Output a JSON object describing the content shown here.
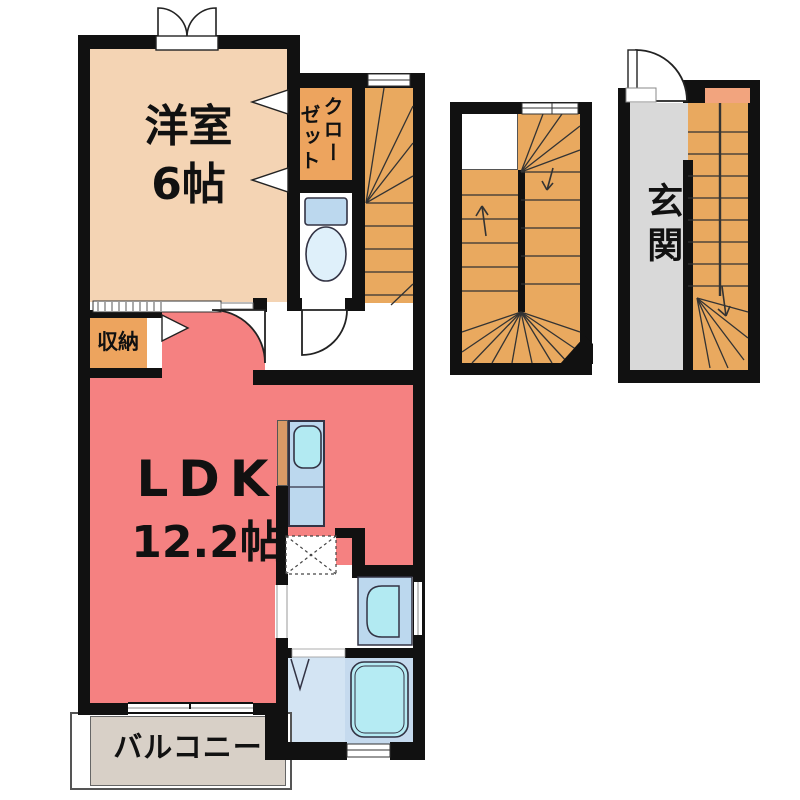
{
  "plan": {
    "type": "apartment-floor-plan",
    "rooms": {
      "western_room": {
        "name": "洋室",
        "size": "6帖"
      },
      "closet": {
        "name": "クローゼット",
        "line1": "クロー",
        "line2": "ゼット"
      },
      "storage": {
        "name": "収納"
      },
      "ldk": {
        "name": "LDK",
        "size": "12.2帖"
      },
      "balcony": {
        "name": "バルコニー"
      },
      "entrance": {
        "name": "玄関"
      }
    },
    "colors": {
      "wall": "#111111",
      "western_room": "#F4D4B4",
      "closet_orange": "#EDA45E",
      "stairs_orange": "#E9A95F",
      "ldk_pink": "#F58181",
      "entrance_gray": "#D9D9D9",
      "balcony": "#D8D0C7",
      "fixture_blue": "#BCD8EE",
      "fixture_cyan": "#B2EAF2",
      "bath_floor": "#D3E4F3",
      "landing_salmon": "#F2A47E"
    },
    "fixtures": [
      "toilet-icon",
      "kitchen-sink-icon",
      "refrigerator-space",
      "washbasin-icon",
      "bathtub-icon",
      "stair-treads",
      "door-arc",
      "window"
    ]
  }
}
